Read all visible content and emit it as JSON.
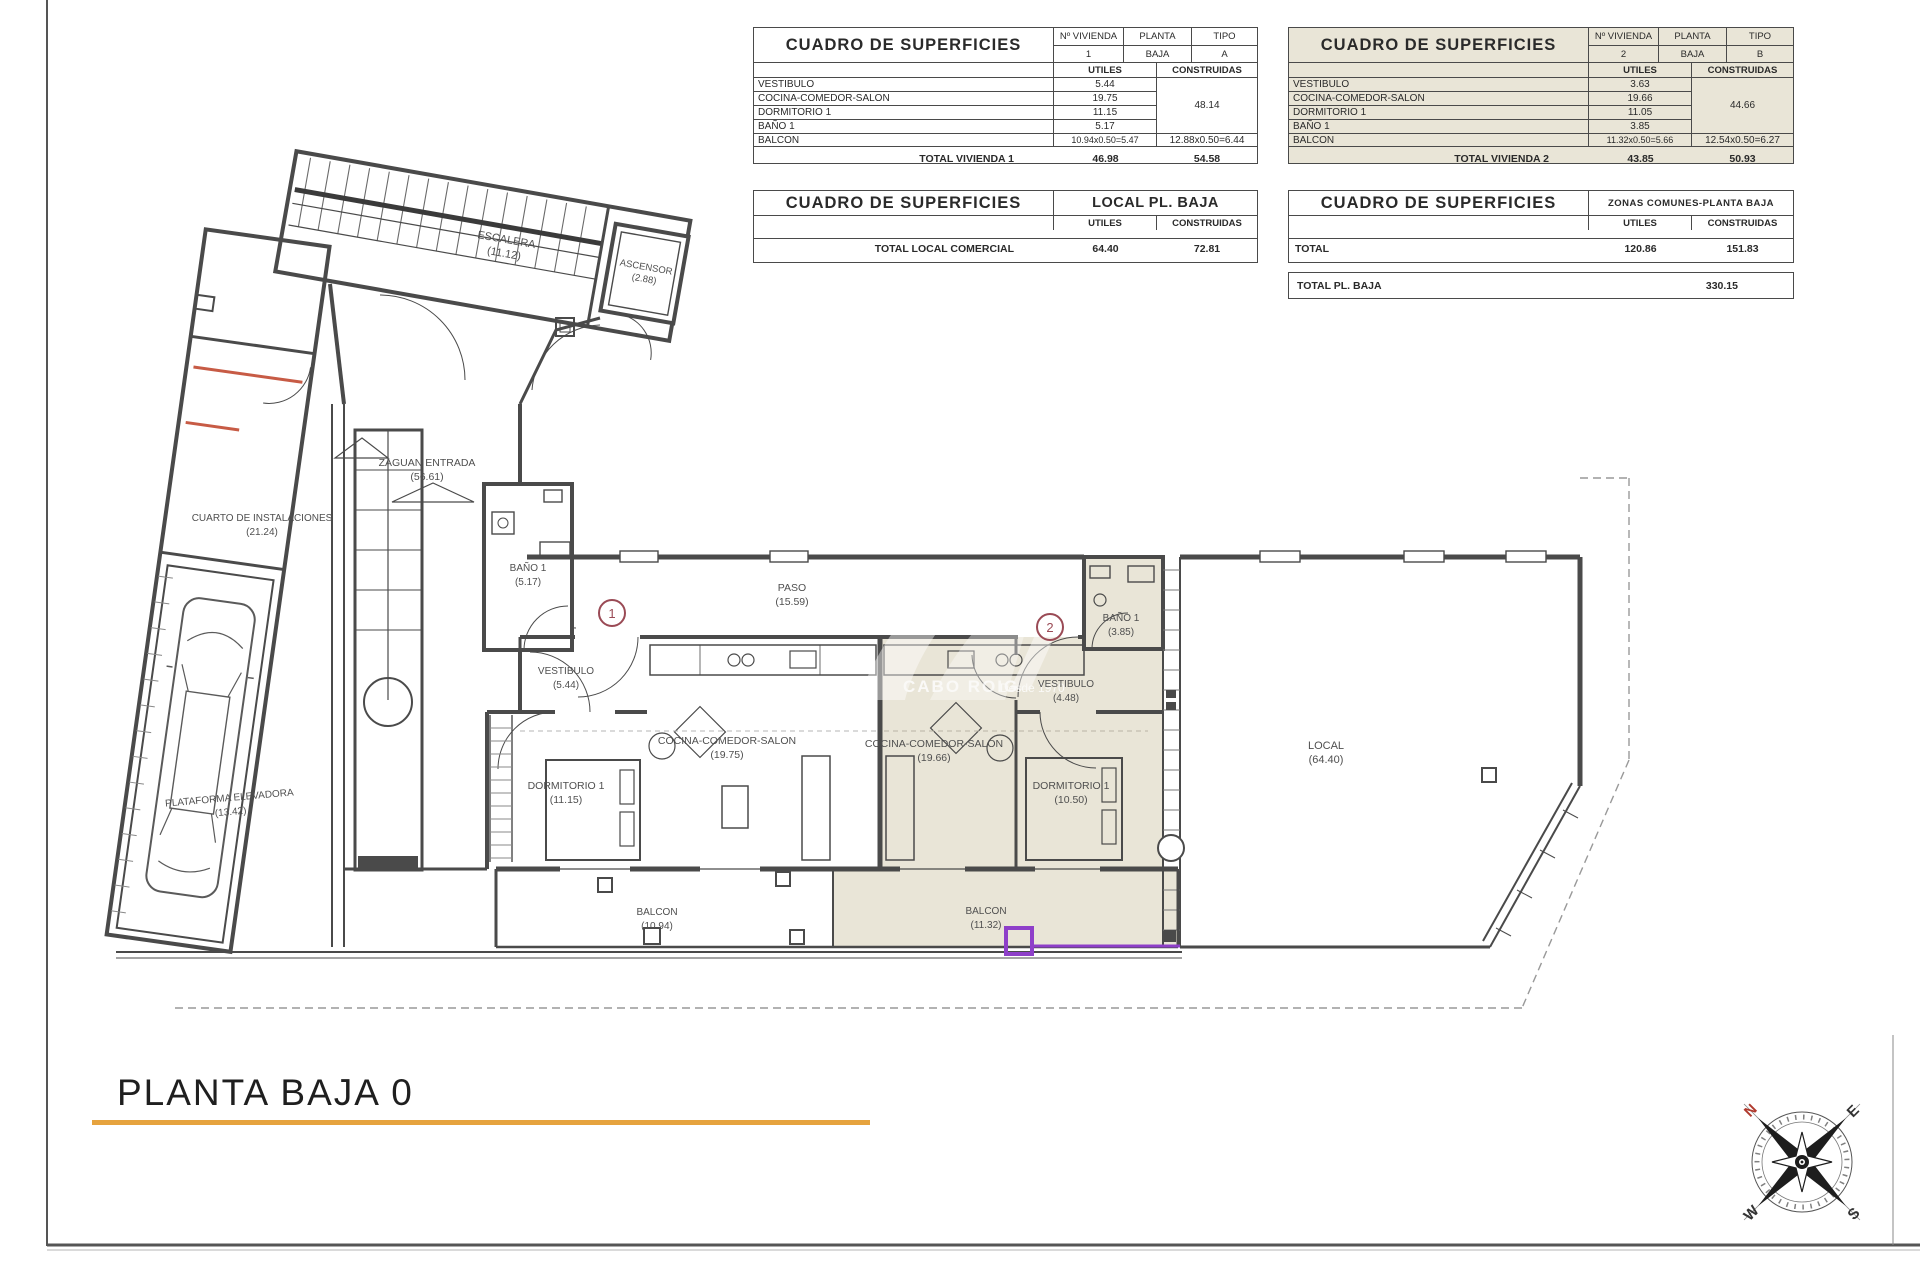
{
  "page": {
    "title": "PLANTA BAJA 0",
    "colors": {
      "gold": "#E6A33E",
      "beige": "#E9E5D7",
      "purple": "#8E3FC9",
      "marker_red": "#9A4A55",
      "orange": "#C75B45"
    }
  },
  "tables": {
    "headers": {
      "cuadro": "CUADRO DE SUPERFICIES",
      "utiles": "UTILES",
      "construidas": "CONSTRUIDAS",
      "num_vivienda": "Nº VIVIENDA",
      "planta": "PLANTA",
      "tipo": "TIPO"
    },
    "vivienda1": {
      "num": "1",
      "planta": "BAJA",
      "tipo": "A",
      "rows": [
        {
          "label": "VESTIBULO",
          "utiles": "5.44"
        },
        {
          "label": "COCINA-COMEDOR-SALON",
          "utiles": "19.75"
        },
        {
          "label": "DORMITORIO 1",
          "utiles": "11.15"
        },
        {
          "label": "BAÑO 1",
          "utiles": "5.17"
        }
      ],
      "construidas_partial": "48.14",
      "balcon_label": "BALCON",
      "balcon_utiles": "10.94x0.50=5.47",
      "balcon_construidas": "12.88x0.50=6.44",
      "total_label": "TOTAL VIVIENDA 1",
      "total_utiles": "46.98",
      "total_construidas": "54.58"
    },
    "vivienda2": {
      "num": "2",
      "planta": "BAJA",
      "tipo": "B",
      "rows": [
        {
          "label": "VESTIBULO",
          "utiles": "3.63"
        },
        {
          "label": "COCINA-COMEDOR-SALON",
          "utiles": "19.66"
        },
        {
          "label": "DORMITORIO 1",
          "utiles": "11.05"
        },
        {
          "label": "BAÑO 1",
          "utiles": "3.85"
        }
      ],
      "construidas_partial": "44.66",
      "balcon_label": "BALCON",
      "balcon_utiles": "11.32x0.50=5.66",
      "balcon_construidas": "12.54x0.50=6.27",
      "total_label": "TOTAL VIVIENDA 2",
      "total_utiles": "43.85",
      "total_construidas": "50.93"
    },
    "local": {
      "subtitle": "LOCAL PL. BAJA",
      "total_label": "TOTAL LOCAL COMERCIAL",
      "total_utiles": "64.40",
      "total_construidas": "72.81"
    },
    "comunes": {
      "subtitle": "ZONAS COMUNES-PLANTA BAJA",
      "total_label": "TOTAL",
      "total_utiles": "120.86",
      "total_construidas": "151.83"
    },
    "total_planta": {
      "label": "TOTAL PL. BAJA",
      "value": "330.15"
    }
  },
  "plan": {
    "rooms": {
      "escalera": {
        "name": "ESCALERA",
        "area": "(11.12)"
      },
      "ascensor": {
        "name": "ASCENSOR",
        "area": "(2.88)"
      },
      "zaguan": {
        "name": "ZAGUAN ENTRADA",
        "area": "(56.61)"
      },
      "cuarto": {
        "name": "CUARTO DE INSTALACIONES",
        "area": "(21.24)"
      },
      "bano_v1": {
        "name": "BAÑO 1",
        "area": "(5.17)"
      },
      "paso": {
        "name": "PASO",
        "area": "(15.59)"
      },
      "vestibulo_v1": {
        "name": "VESTIBULO",
        "area": "(5.44)"
      },
      "cocina_v1": {
        "name": "COCINA-COMEDOR-SALON",
        "area": "(19.75)"
      },
      "dormitorio_v1": {
        "name": "DORMITORIO 1",
        "area": "(11.15)"
      },
      "balcon_v1": {
        "name": "BALCON",
        "area": "(10.94)"
      },
      "cocina_v2": {
        "name": "COCINA-COMEDOR-SALON",
        "area": "(19.66)"
      },
      "dormitorio_v2": {
        "name": "DORMITORIO 1",
        "area": "(10.50)"
      },
      "vestibulo_v2": {
        "name": "VESTIBULO",
        "area": "(4.48)"
      },
      "bano_v2": {
        "name": "BAÑO 1",
        "area": "(3.85)"
      },
      "balcon_v2": {
        "name": "BALCON",
        "area": "(11.32)"
      },
      "local": {
        "name": "LOCAL",
        "area": "(64.40)"
      },
      "plataforma": {
        "name": "PLATAFORMA ELEVADORA",
        "area": "(13.42)"
      }
    },
    "markers": {
      "m1": "1",
      "m2": "2"
    },
    "watermark": {
      "brand": "CABO ROIG",
      "tagline": "Desde 1970"
    },
    "compass": {
      "n": "N",
      "e": "E",
      "s": "S",
      "w": "W"
    }
  }
}
